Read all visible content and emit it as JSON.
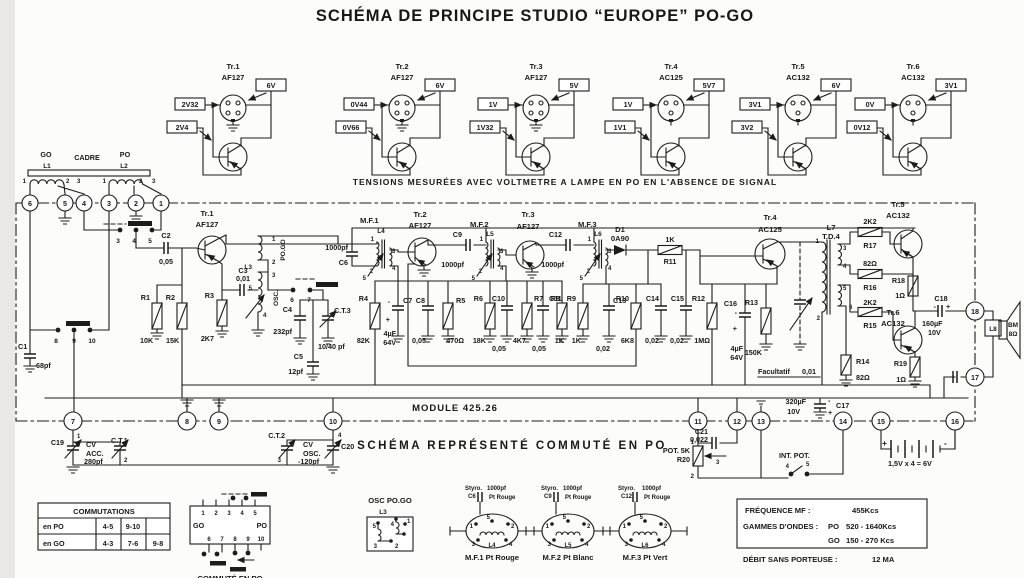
{
  "title": "SCHÉMA DE PRINCIPE STUDIO “EUROPE” PO-GO",
  "measurement_note": "TENSIONS MESURÉES AVEC VOLTMETRE A LAMPE EN PO EN L'ABSENCE DE SIGNAL",
  "module_label": "MODULE 425.26",
  "schema_note": "SCHÉMA REPRÉSENTÉ COMMUTÉ EN PO",
  "top_transistors": [
    {
      "name": "Tr.1",
      "type": "AF127",
      "v1": "2V32",
      "v2": "2V4",
      "v3": "6V"
    },
    {
      "name": "Tr.2",
      "type": "AF127",
      "v1": "0V44",
      "v2": "0V66",
      "v3": "6V"
    },
    {
      "name": "Tr.3",
      "type": "AF127",
      "v1": "1V",
      "v2": "1V32",
      "v3": "5V"
    },
    {
      "name": "Tr.4",
      "type": "AC125",
      "v1": "1V",
      "v2": "1V1",
      "v3": "5V7"
    },
    {
      "name": "Tr.5",
      "type": "AC132",
      "v1": "3V1",
      "v2": "3V2",
      "v3": "6V"
    },
    {
      "name": "Tr.6",
      "type": "AC132",
      "v1": "0V",
      "v2": "0V12",
      "v3": "3V1"
    }
  ],
  "antenna": {
    "go": "GO",
    "cadre": "CADRE",
    "po": "PO",
    "l1": "L1",
    "l2": "L2"
  },
  "terminals": {
    "t1": "1",
    "t2": "2",
    "t3": "3",
    "t4": "4",
    "t5": "5",
    "t6": "6",
    "t7": "7",
    "t8": "8",
    "t9": "9",
    "t10": "10",
    "t11": "11",
    "t12": "12",
    "t13": "13",
    "t14": "14",
    "t15": "15",
    "t16": "16",
    "t17": "17",
    "t18": "18"
  },
  "pins": {
    "l1": [
      "1",
      "2",
      "3"
    ],
    "l2": [
      "1",
      "2",
      "3"
    ],
    "s345": [
      "3",
      "4",
      "5"
    ],
    "s8910": [
      "8",
      "9",
      "10"
    ],
    "s67": [
      "6",
      "7"
    ],
    "l3": [
      "1",
      "2",
      "3",
      "5",
      "4"
    ],
    "mf1": [
      "1",
      "5",
      "2",
      "3",
      "4"
    ],
    "mf2": [
      "1",
      "5",
      "2",
      "3",
      "4"
    ],
    "mf3": [
      "1",
      "5",
      "2",
      "3",
      "4"
    ],
    "l7": [
      "1",
      "2",
      "3",
      "4",
      "5",
      "6"
    ],
    "c19": [
      "1",
      "2"
    ],
    "c20": [
      "3",
      "4"
    ],
    "r20": [
      "1",
      "2",
      "3"
    ],
    "intpot": [
      "4",
      "5"
    ],
    "can": [
      "5",
      "1",
      "2",
      "3",
      "4"
    ]
  },
  "parts": {
    "c1": {
      "n": "C1",
      "v": "68pf"
    },
    "c2": {
      "n": "C2",
      "v": "0,05"
    },
    "r1": {
      "n": "R1",
      "v": "10K"
    },
    "r2": {
      "n": "R2",
      "v": "15K"
    },
    "tr1": {
      "n": "Tr.1",
      "t": "AF127"
    },
    "r3": {
      "n": "R3",
      "v": "2K7"
    },
    "c3": {
      "n": "C3",
      "v": "0,01"
    },
    "l3": {
      "n": "L3",
      "po_go": "PO.GO",
      "osc": "OSC."
    },
    "c4": {
      "n": "C4",
      "v": "232pf"
    },
    "ct3": {
      "n": "C.T.3",
      "v": "10/40 pf"
    },
    "c5": {
      "n": "C5",
      "v": "12pf"
    },
    "c6": {
      "n": "C6",
      "v": "1000pf"
    },
    "mf1": {
      "n": "M.F.1",
      "l": "L4"
    },
    "r4": {
      "n": "R4",
      "v": "82K"
    },
    "tr2": {
      "n": "Tr.2",
      "t": "AF127"
    },
    "c7": {
      "n": "C7",
      "v": "4µF",
      "v2": "64V"
    },
    "c8": {
      "n": "C8",
      "v": "0,05"
    },
    "r5": {
      "n": "R5",
      "v": "470Ω"
    },
    "c9": {
      "n": "C9",
      "v": "1000pf"
    },
    "mf2": {
      "n": "M.F.2",
      "l": "L5"
    },
    "tr3": {
      "n": "Tr.3",
      "t": "AF127"
    },
    "r6": {
      "n": "R6",
      "v": "18K"
    },
    "c10": {
      "n": "C10",
      "v": "0,05"
    },
    "r7": {
      "n": "R7",
      "v": "4K7"
    },
    "c11": {
      "n": "C11",
      "v": "0,05"
    },
    "r8": {
      "n": "R8",
      "v": "1K"
    },
    "c12": {
      "n": "C12",
      "v": "1000pf"
    },
    "mf3": {
      "n": "M.F.3",
      "l": "L6"
    },
    "r9": {
      "n": "R9",
      "v": "1K"
    },
    "c13": {
      "n": "C13",
      "v": "0,02"
    },
    "d1": {
      "n": "D1",
      "t": "0A90"
    },
    "r10": {
      "n": "R10",
      "v": "6K8"
    },
    "c14": {
      "n": "C14",
      "v": "0,02"
    },
    "r11": {
      "n": "R11",
      "v": "1K"
    },
    "c15": {
      "n": "C15",
      "v": "0,02"
    },
    "r12": {
      "n": "R12",
      "v": "1MΩ"
    },
    "c16": {
      "n": "C16",
      "v": "4µF",
      "v2": "64V"
    },
    "r13": {
      "n": "R13",
      "v": "150K"
    },
    "tr4": {
      "n": "Tr.4",
      "t": "AC125"
    },
    "fac": {
      "label": "Facultatif",
      "v": "0,01"
    },
    "l7": {
      "n": "L7",
      "t": "T.D.4"
    },
    "r17": {
      "n": "R17",
      "v": "2K2"
    },
    "r16": {
      "n": "R16",
      "v": "82Ω"
    },
    "r15": {
      "n": "R15",
      "v": "2K2"
    },
    "r14": {
      "n": "R14",
      "v": "82Ω"
    },
    "tr5": {
      "n": "Tr.5",
      "t": "AC132"
    },
    "tr6": {
      "n": "Tr.6",
      "t": "AC132"
    },
    "r18": {
      "n": "R18",
      "v": "1Ω"
    },
    "r19": {
      "n": "R19",
      "v": "1Ω"
    },
    "c18": {
      "n": "C18",
      "v": "160µF",
      "v2": "10V"
    },
    "l8": {
      "n": "L8"
    },
    "bm": {
      "n": "BM",
      "v": "8Ω"
    },
    "c19": {
      "n": "C19",
      "l1": "CV",
      "l2": "ACC.",
      "v": "280pf"
    },
    "ct1": {
      "n": "C.T.1"
    },
    "ct2": {
      "n": "C.T.2"
    },
    "c20": {
      "n": "C20",
      "l1": "CV",
      "l2": "OSC.",
      "v": "-120pf"
    },
    "r20": {
      "label": "POT. 5K",
      "n": "R20"
    },
    "c21": {
      "n": "C21",
      "v": "0,022"
    },
    "c17": {
      "n": "C17",
      "v": "320µF",
      "v2": "10V"
    },
    "intpot": {
      "label": "INT. POT."
    },
    "battery": {
      "plus": "+",
      "minus": "-",
      "v": "1,5V x 4 = 6V"
    }
  },
  "sym": {
    "plus": "+",
    "minus": "-"
  },
  "commutations": {
    "title": "COMMUTATIONS",
    "rows": [
      {
        "label": "en PO",
        "c1": "4-5",
        "c2": "9-10",
        "c3": ""
      },
      {
        "label": "en GO",
        "c1": "4-3",
        "c2": "7-6",
        "c3": "9-8"
      }
    ]
  },
  "connector": {
    "go": "GO",
    "po": "PO",
    "caption": "COMMUTÉ EN PO",
    "top": [
      "1",
      "2",
      "3",
      "4",
      "5"
    ],
    "bottom": [
      "6",
      "7",
      "8",
      "9",
      "10"
    ]
  },
  "osc_box": {
    "title": "OSC PO.GO",
    "l": "L3",
    "pins": [
      "5",
      "4",
      "1",
      "3",
      "2"
    ]
  },
  "mf_cans": [
    {
      "styro": "Styro.",
      "cap": "C6",
      "val": "1000pf",
      "dot": "Pt Rouge",
      "coil": "L4",
      "caption": "M.F.1  Pt Rouge"
    },
    {
      "styro": "Styro.",
      "cap": "C9",
      "val": "1000pf",
      "dot": "Pt Rouge",
      "coil": "L5",
      "caption": "M.F.2  Pt Blanc"
    },
    {
      "styro": "Styro.",
      "cap": "C12",
      "val": "1000pf",
      "dot": "Pt Rouge",
      "coil": "L6",
      "caption": "M.F.3  Pt Vert"
    }
  ],
  "specs": {
    "freq_label": "FRÉQUENCE  MF :",
    "freq_value": "455Kcs",
    "bands_label": "GAMMES D'ONDES :",
    "po": "PO",
    "po_range": "520 - 1640Kcs",
    "go": "GO",
    "go_range": "150 - 270 Kcs",
    "debit_label": "DÉBIT SANS PORTEUSE :",
    "debit_value": "12 MA"
  }
}
